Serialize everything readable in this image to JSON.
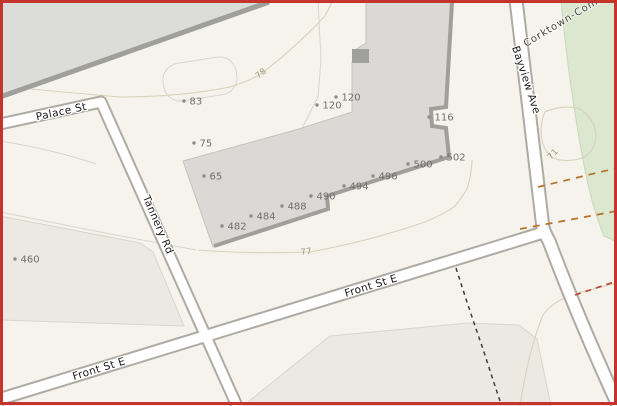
{
  "colors": {
    "bg": "#f6f3ec",
    "parcel": "#ebe9e2",
    "parcel_line": "#d9d5cb",
    "green": "#dbe7cf",
    "green_edge": "#c9d8b9",
    "corridor": "#dcdcda",
    "dark_edge": "#9f9f9b",
    "building": "#dbd9d5",
    "building_edge": "#c6c2ba",
    "road_casing": "#aeaaa4",
    "road_fill": "#ffffff",
    "contour": "#d9d1ba",
    "dash_orange": "#b5722d",
    "dash_red": "#b84a35",
    "dash_path": "#3c3c3c",
    "addr_text": "#6f6f6f",
    "addr_dot": "#8c8c88",
    "street_text": "#1a1a1a",
    "contour_text": "#a09878",
    "park_text": "#4a463c",
    "border": "#c5342c"
  },
  "streets": {
    "palace": {
      "label": "Palace St"
    },
    "tannery": {
      "label": "Tannery Rd"
    },
    "front_west": {
      "label": "Front St E"
    },
    "front_east": {
      "label": "Front St E"
    },
    "bayview": {
      "label": "Bayview Ave"
    }
  },
  "park": {
    "label": "Corktown-Common"
  },
  "contours": {
    "c78": {
      "label": "78"
    },
    "c77": {
      "label": "77"
    },
    "c71": {
      "label": "71"
    }
  },
  "addresses": [
    {
      "number": "460",
      "x": 15,
      "y": 259
    },
    {
      "number": "83",
      "x": 184,
      "y": 101
    },
    {
      "number": "75",
      "x": 194,
      "y": 143
    },
    {
      "number": "65",
      "x": 204,
      "y": 176
    },
    {
      "number": "120",
      "x": 317,
      "y": 105
    },
    {
      "number": "120",
      "x": 336,
      "y": 97
    },
    {
      "number": "116",
      "x": 429,
      "y": 117
    },
    {
      "number": "482",
      "x": 222,
      "y": 226
    },
    {
      "number": "484",
      "x": 251,
      "y": 216
    },
    {
      "number": "488",
      "x": 282,
      "y": 206
    },
    {
      "number": "490",
      "x": 311,
      "y": 196
    },
    {
      "number": "494",
      "x": 344,
      "y": 186
    },
    {
      "number": "496",
      "x": 373,
      "y": 176
    },
    {
      "number": "500",
      "x": 408,
      "y": 164
    },
    {
      "number": "502",
      "x": 441,
      "y": 157
    }
  ]
}
